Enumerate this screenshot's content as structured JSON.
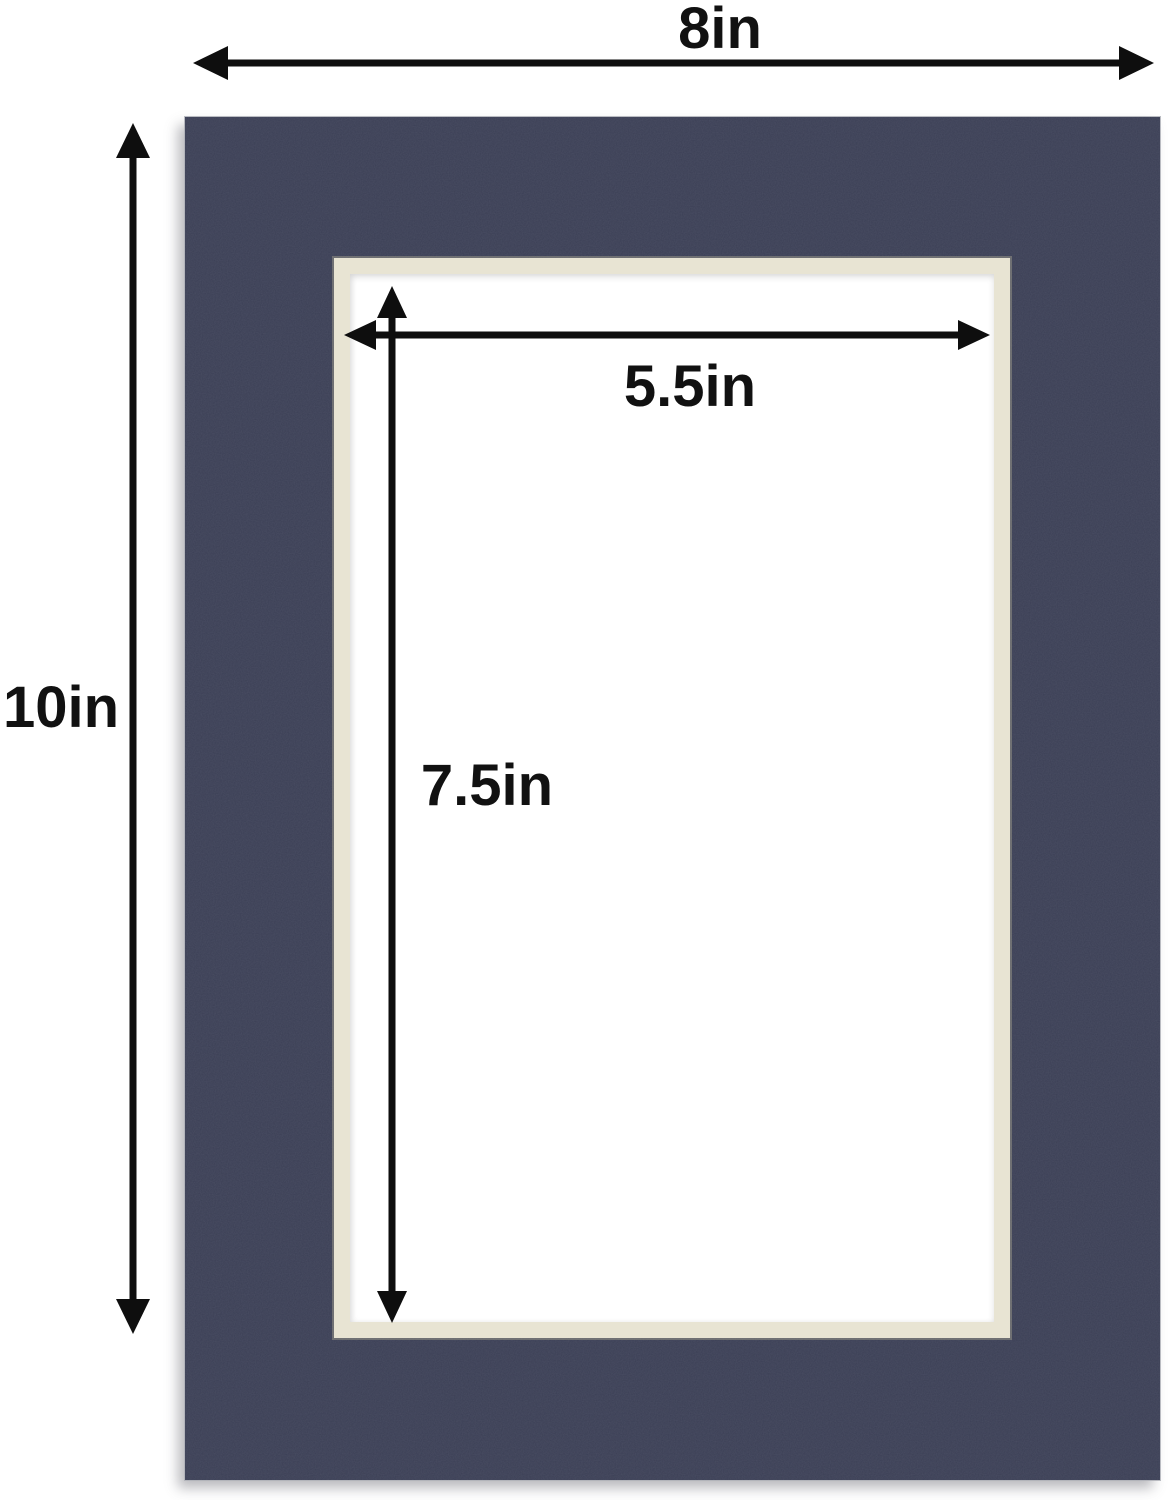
{
  "diagram": {
    "description": "Picture frame mat board dimension diagram",
    "labels": {
      "outer_width": "8in",
      "outer_height": "10in",
      "opening_width": "5.5in",
      "opening_height": "7.5in"
    },
    "colors": {
      "mat": "#3b3f55",
      "bevel": "#e8e4d3",
      "bevel_edge": "#b3b0a1",
      "arrow": "#0e0e0e",
      "label": "#111111",
      "background": "#ffffff"
    }
  }
}
